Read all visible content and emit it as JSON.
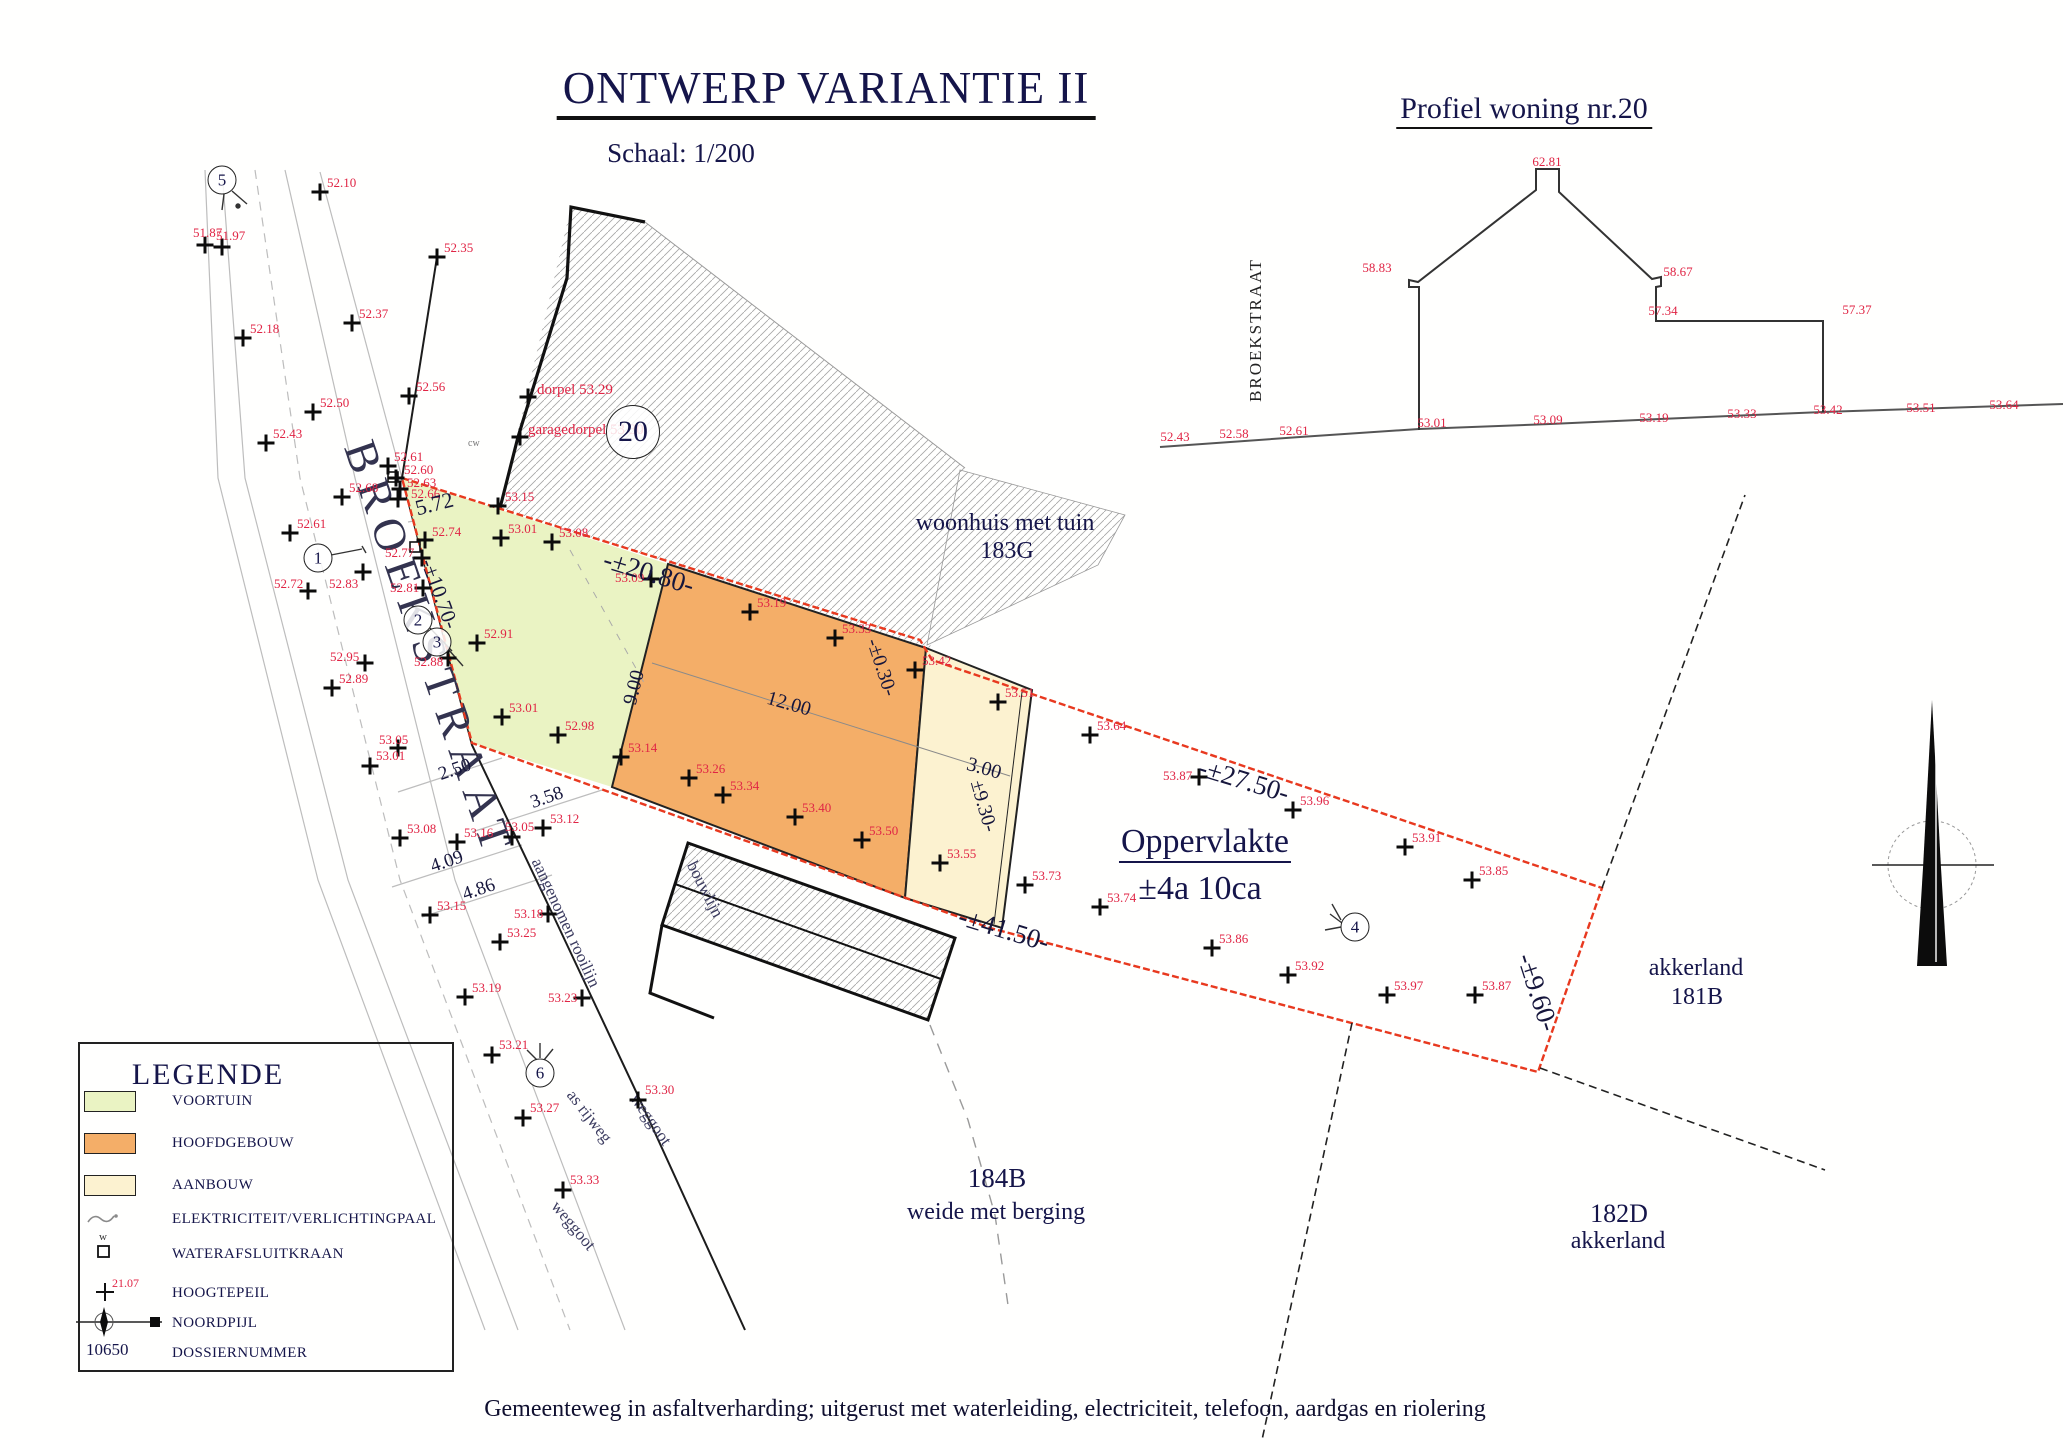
{
  "colors": {
    "voortuin": "#eaf3c3",
    "hoofdgebouw": "#f4ae68",
    "aanbouw": "#fcf2d0",
    "boundary_red": "#e8391f",
    "elevation_red": "#e02545",
    "ink": "#15154a"
  },
  "header": {
    "title": "ONTWERP VARIANTIE II",
    "scale": "Schaal: 1/200"
  },
  "profile": {
    "title": "Profiel woning nr.20",
    "street": "BROEKSTRAAT",
    "labels": [
      {
        "t": "62.81",
        "x": 1547,
        "y": 155
      },
      {
        "t": "58.83",
        "x": 1377,
        "y": 261
      },
      {
        "t": "58.67",
        "x": 1678,
        "y": 265
      },
      {
        "t": "57.34",
        "x": 1663,
        "y": 304
      },
      {
        "t": "57.37",
        "x": 1857,
        "y": 303
      }
    ],
    "ground": [
      [
        "52.43",
        1175,
        430
      ],
      [
        "52.58",
        1234,
        427
      ],
      [
        "52.61",
        1294,
        424
      ],
      [
        "53.01",
        1432,
        416
      ],
      [
        "53.09",
        1548,
        413
      ],
      [
        "53.19",
        1654,
        411
      ],
      [
        "53.33",
        1742,
        407
      ],
      [
        "53.42",
        1828,
        403
      ],
      [
        "53.51",
        1921,
        401
      ],
      [
        "53.64",
        2004,
        398
      ]
    ]
  },
  "plan": {
    "street": "BROEKSTRAAT",
    "labels": {
      "rooilijn": "aangenomen rooilijn",
      "as_rijweg": "as rijweg",
      "weggoot1": "weggoot",
      "weggoot2": "weggoot",
      "bouwlijn": "bouwlijn",
      "cw": "cw",
      "woonhuis": "woonhuis met tuin",
      "woonhuis_nr": "183G",
      "parcel_184": "184B",
      "parcel_184_sub": "weide met berging",
      "akkerland_181": "akkerland",
      "parcel_181": "181B",
      "parcel_182": "182D",
      "akkerland_182": "akkerland",
      "opp_title": "Oppervlakte",
      "opp_value": "±4a 10ca"
    },
    "dimensions": [
      {
        "t": "5.72",
        "x": 413,
        "y": 498,
        "r": -14,
        "s": 22
      },
      {
        "t": "-±10.70-",
        "x": 437,
        "y": 556,
        "r": 70,
        "s": 21
      },
      {
        "t": "2.50",
        "x": 436,
        "y": 766,
        "r": -19,
        "s": 19
      },
      {
        "t": "3.58",
        "x": 528,
        "y": 794,
        "r": -19,
        "s": 19
      },
      {
        "t": "4.09",
        "x": 428,
        "y": 858,
        "r": -19,
        "s": 19
      },
      {
        "t": "4.86",
        "x": 460,
        "y": 886,
        "r": -19,
        "s": 19
      },
      {
        "t": "9.00",
        "x": 620,
        "y": 702,
        "r": -76,
        "s": 20
      },
      {
        "t": "12.00",
        "x": 770,
        "y": 688,
        "r": 16,
        "s": 20
      },
      {
        "t": "3.00",
        "x": 970,
        "y": 754,
        "r": 16,
        "s": 20
      },
      {
        "t": "±9.30-",
        "x": 986,
        "y": 778,
        "r": 74,
        "s": 20
      },
      {
        "t": "-±0.30-",
        "x": 882,
        "y": 636,
        "r": 72,
        "s": 20
      },
      {
        "t": "-±20.80-",
        "x": 608,
        "y": 546,
        "r": 17,
        "s": 27
      },
      {
        "t": "-±27.50-",
        "x": 1203,
        "y": 754,
        "r": 17,
        "s": 27
      },
      {
        "t": "-±41.50-",
        "x": 963,
        "y": 903,
        "r": 17,
        "s": 27
      },
      {
        "t": "-±9.60-",
        "x": 1538,
        "y": 950,
        "r": 72,
        "s": 27
      }
    ],
    "stations": [
      {
        "n": "5",
        "x": 222,
        "y": 180
      },
      {
        "n": "1",
        "x": 318,
        "y": 558
      },
      {
        "n": "2",
        "x": 418,
        "y": 620
      },
      {
        "n": "3",
        "x": 437,
        "y": 642
      },
      {
        "n": "6",
        "x": 540,
        "y": 1073
      },
      {
        "n": "4",
        "x": 1355,
        "y": 927
      },
      {
        "n": "20",
        "x": 633,
        "y": 432,
        "d": 52
      }
    ],
    "points": [
      [
        "51.87",
        205,
        245,
        193,
        226
      ],
      [
        "51.97",
        222,
        247,
        216,
        229
      ],
      [
        "52.10",
        320,
        192,
        327,
        176
      ],
      [
        "52.35",
        437,
        257,
        444,
        241
      ],
      [
        "52.18",
        243,
        338,
        250,
        322
      ],
      [
        "52.37",
        352,
        323,
        359,
        307
      ],
      [
        "52.56",
        409,
        396,
        416,
        380
      ],
      [
        "52.50",
        313,
        412,
        320,
        396
      ],
      [
        "52.43",
        266,
        443,
        273,
        427
      ],
      [
        "52.61",
        388,
        466,
        394,
        450
      ],
      [
        "52.60",
        396,
        478,
        404,
        463
      ],
      [
        "52.63",
        400,
        489,
        407,
        476
      ],
      [
        "52.66",
        398,
        499,
        411,
        487
      ],
      [
        "52.68",
        342,
        497,
        349,
        481
      ],
      [
        "52.61",
        290,
        533,
        297,
        517
      ],
      [
        "52.74",
        425,
        540,
        432,
        525
      ],
      [
        "52.77",
        422,
        558,
        385,
        546
      ],
      [
        "52.72",
        308,
        591,
        274,
        577
      ],
      [
        "52.83",
        363,
        572,
        329,
        577
      ],
      [
        "52.81",
        423,
        588,
        390,
        581
      ],
      [
        "52.91",
        477,
        643,
        484,
        627
      ],
      [
        "52.88",
        448,
        658,
        414,
        655
      ],
      [
        "52.95",
        365,
        663,
        330,
        650
      ],
      [
        "52.89",
        332,
        688,
        339,
        672
      ],
      [
        "53.05",
        398,
        748,
        379,
        733
      ],
      [
        "53.01",
        370,
        766,
        376,
        749
      ],
      [
        "53.08",
        400,
        838,
        407,
        822
      ],
      [
        "53.16",
        457,
        842,
        464,
        826
      ],
      [
        "53.05",
        512,
        837,
        505,
        820
      ],
      [
        "53.12",
        543,
        828,
        550,
        812
      ],
      [
        "53.15",
        430,
        915,
        437,
        899
      ],
      [
        "53.18",
        548,
        914,
        514,
        907
      ],
      [
        "53.25",
        500,
        942,
        507,
        926
      ],
      [
        "53.19",
        465,
        997,
        472,
        981
      ],
      [
        "53.23",
        582,
        998,
        548,
        991
      ],
      [
        "53.21",
        492,
        1055,
        499,
        1038
      ],
      [
        "53.27",
        523,
        1118,
        530,
        1101
      ],
      [
        "53.30",
        638,
        1100,
        645,
        1083
      ],
      [
        "53.33",
        563,
        1190,
        570,
        1173
      ],
      [
        "53.15",
        498,
        506,
        505,
        490
      ],
      [
        "53.01",
        501,
        538,
        508,
        522
      ],
      [
        "53.08",
        552,
        542,
        559,
        526
      ],
      [
        "53.09",
        651,
        579,
        615,
        571
      ],
      [
        "52.98",
        558,
        735,
        565,
        719
      ],
      [
        "53.01",
        502,
        717,
        509,
        701
      ],
      [
        "53.14",
        621,
        757,
        628,
        741
      ],
      [
        "53.19",
        750,
        612,
        757,
        596
      ],
      [
        "53.33",
        835,
        638,
        842,
        622
      ],
      [
        "53.42",
        915,
        670,
        922,
        654
      ],
      [
        "53.51",
        998,
        702,
        1005,
        686
      ],
      [
        "53.26",
        689,
        778,
        696,
        762
      ],
      [
        "53.34",
        723,
        795,
        730,
        779
      ],
      [
        "53.40",
        795,
        817,
        802,
        801
      ],
      [
        "53.50",
        862,
        840,
        869,
        824
      ],
      [
        "53.55",
        940,
        863,
        947,
        847
      ],
      [
        "53.73",
        1025,
        885,
        1032,
        869
      ],
      [
        "53.64",
        1090,
        735,
        1097,
        719
      ],
      [
        "53.87",
        1199,
        777,
        1163,
        769
      ],
      [
        "53.96",
        1293,
        810,
        1300,
        794
      ],
      [
        "53.91",
        1405,
        847,
        1412,
        831
      ],
      [
        "53.85",
        1472,
        880,
        1479,
        864
      ],
      [
        "53.74",
        1100,
        907,
        1107,
        891
      ],
      [
        "53.86",
        1212,
        948,
        1219,
        932
      ],
      [
        "53.92",
        1288,
        975,
        1295,
        959
      ],
      [
        "53.97",
        1387,
        995,
        1394,
        979
      ],
      [
        "53.87",
        1475,
        995,
        1482,
        979
      ],
      [
        "dorpel 53.29",
        528,
        397,
        537,
        383
      ],
      [
        "garagedorpel 53.30",
        520,
        437,
        528,
        423
      ]
    ]
  },
  "legend": {
    "title": "LEGENDE",
    "items": [
      {
        "label": "VOORTUIN",
        "swatch": "#eaf3c3"
      },
      {
        "label": "HOOFDGEBOUW",
        "swatch": "#f4ae68"
      },
      {
        "label": "AANBOUW",
        "swatch": "#fcf2d0"
      },
      {
        "label": "ELEKTRICITEIT/VERLICHTINGPAAL"
      },
      {
        "label": "WATERAFSLUITKRAAN"
      },
      {
        "label": "HOOGTEPEIL"
      },
      {
        "label": "NOORDPIJL"
      },
      {
        "label": "DOSSIERNUMMER"
      }
    ],
    "sample_height": "21.07",
    "water_letter": "w",
    "dossier_number": "10650"
  },
  "footer": "Gemeenteweg in asfaltverharding; uitgerust met waterleiding, electriciteit, telefoon, aardgas en riolering"
}
